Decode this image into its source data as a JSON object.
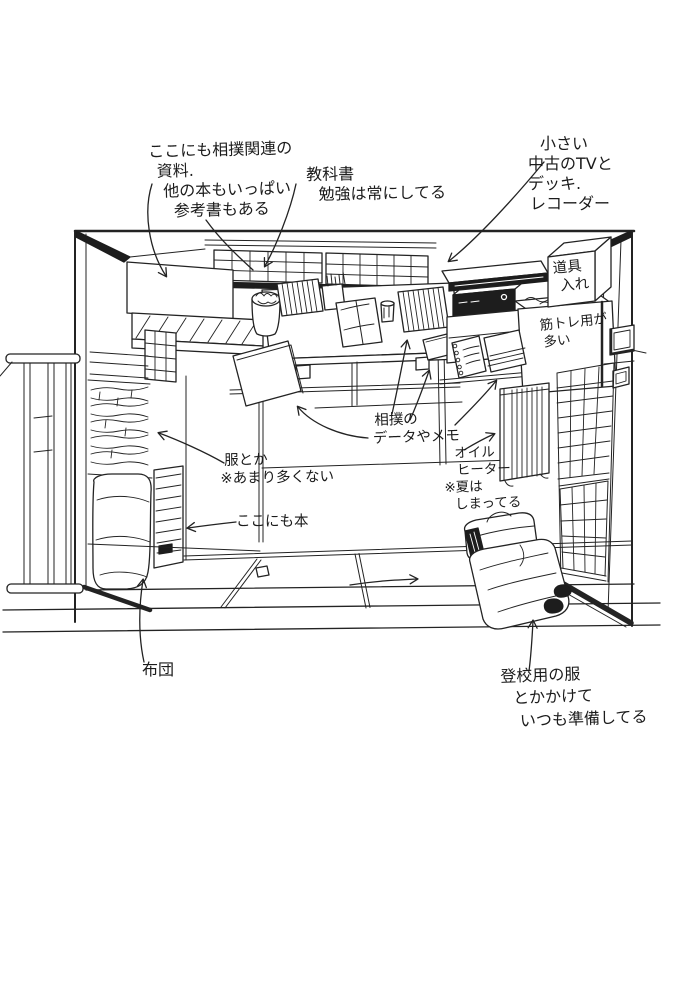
{
  "colors": {
    "ink": "#232323",
    "paper": "#ffffff"
  },
  "annotations": {
    "sumo_materials": {
      "lines": [
        "ここにも相撲関連の",
        "資料.",
        "他の本もいっぱい",
        "参考書もある"
      ]
    },
    "textbooks": {
      "lines": [
        "教科書",
        "勉強は常にしてる"
      ]
    },
    "tv_deck": {
      "lines": [
        "小さい",
        "中古のTVと",
        "デッキ.",
        "レコーダー"
      ]
    },
    "tool_box": {
      "lines": [
        "道具",
        "入れ"
      ]
    },
    "muscle_training": {
      "lines": [
        "筋トレ用が",
        "多い"
      ]
    },
    "sumo_memo": {
      "lines": [
        "相撲の",
        "データやメモ"
      ]
    },
    "oil_heater": {
      "lines": [
        "オイル",
        "ヒーター",
        "※夏は",
        "しまってる"
      ]
    },
    "clothes": {
      "lines": [
        "服とか",
        "※あまり多くない"
      ]
    },
    "books_here": {
      "lines": [
        "ここにも本"
      ]
    },
    "futon": {
      "lines": [
        "布団"
      ]
    },
    "school_clothes": {
      "lines": [
        "登校用の服",
        "とかかけて",
        "いつも準備してる"
      ]
    }
  }
}
